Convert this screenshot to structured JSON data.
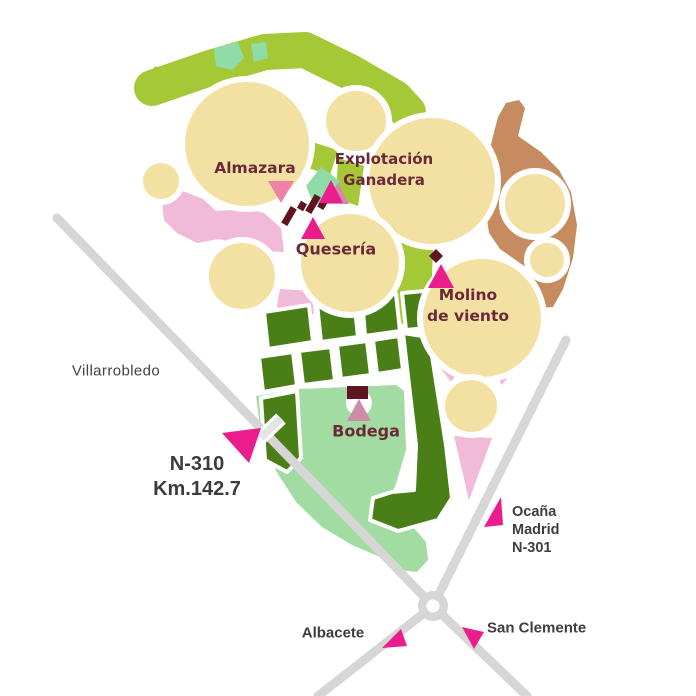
{
  "map": {
    "site_labels": {
      "almazara": "Almazara",
      "explotacion_line1": "Explotación",
      "explotacion_line2": "Ganadera",
      "queseria": "Quesería",
      "molino_line1": "Molino",
      "molino_line2": "de viento",
      "bodega": "Bodega"
    },
    "road_labels": {
      "villarrobledo": "Villarrobledo",
      "n310_line1": "N-310",
      "n310_line2": "Km.142.7",
      "ocana_line1": "Ocaña",
      "ocana_line2": "Madrid",
      "ocana_line3": "N-301",
      "albacete": "Albacete",
      "san_clemente": "San Clemente"
    },
    "colors": {
      "crop_circle": "#F3E1A4",
      "lime_field": "#A5C836",
      "mint_field": "#8FDCA8",
      "mint_meadow": "#A3DCA3",
      "pink_field": "#F1BAD9",
      "vineyard_green": "#4A7F17",
      "brown_field": "#C68C5F",
      "marker_magenta": "#EB1D8D",
      "marker_salmon": "#EF82A6",
      "marker_rose": "#CD8CA8",
      "building_dark_red": "#5E1520",
      "site_label_color": "#6B2937",
      "road_gray": "#D6D6D6",
      "driveway_gray": "#E4E4E4",
      "road_label_color": "#3E3E3E"
    }
  }
}
